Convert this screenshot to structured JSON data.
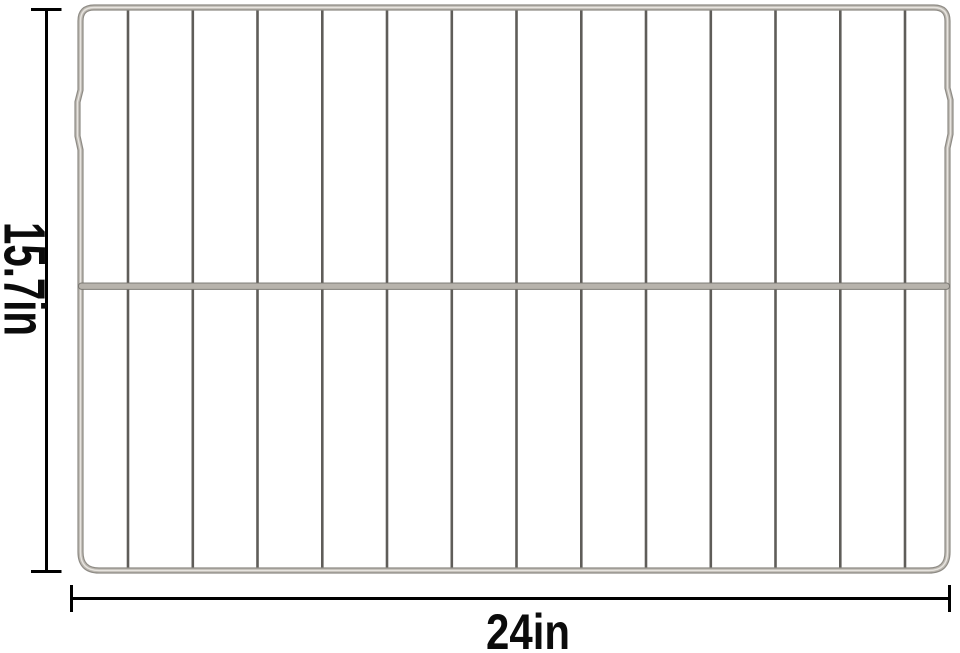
{
  "page": {
    "background_color": "#ffffff",
    "description_label": "oven-rack-dimension-image"
  },
  "annotations": {
    "height": {
      "label": "15.7in"
    },
    "width": {
      "label": "24in"
    },
    "line_color": "#000000",
    "text_color": "#0b0b0b"
  },
  "rack": {
    "bar_count": 13,
    "colors": {
      "frame_outer": "#8e8b85",
      "frame_mid": "#bcb8b1",
      "frame_highlight": "#e7e4df",
      "bars": "#5f5d59",
      "crossbar_fill": "#b7b3ac",
      "crossbar_edge": "#74726d"
    }
  }
}
